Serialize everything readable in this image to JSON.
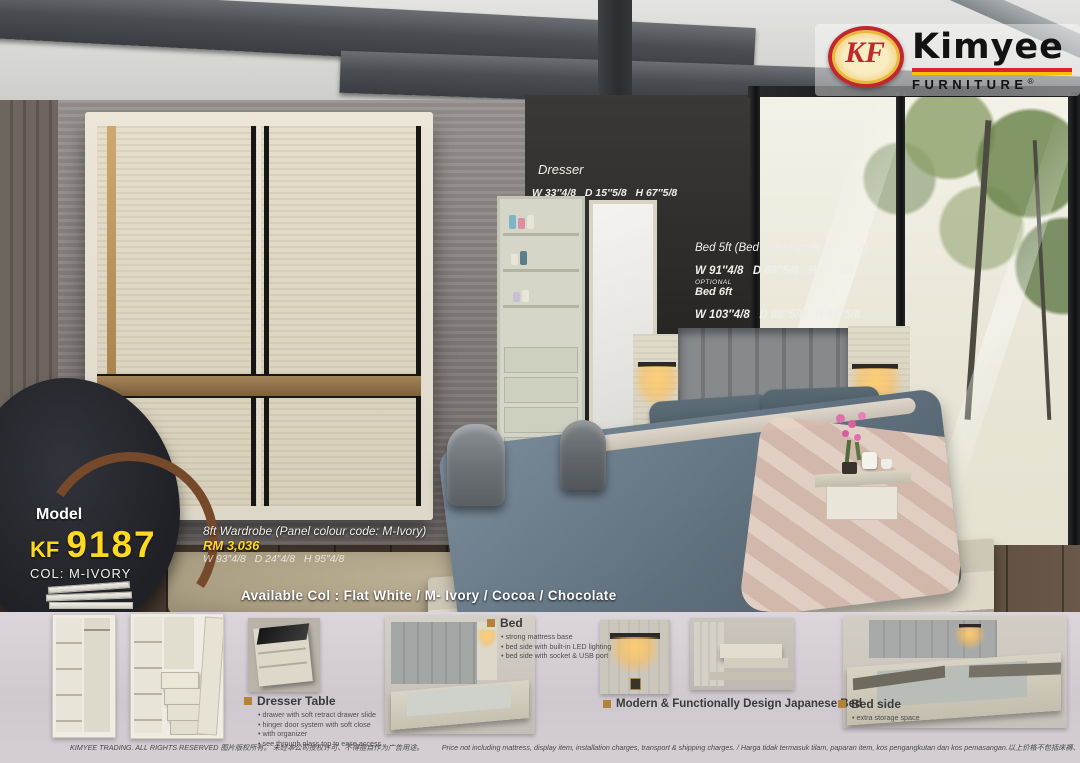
{
  "brand": {
    "badge": "KF",
    "name": "Kimyee",
    "tagline": "FURNITURE",
    "registered": "®",
    "colors": {
      "logo_red": "#c1272d",
      "logo_yellow": "#f5c400",
      "accent_yellow": "#ffd91f"
    }
  },
  "scene": {
    "dresser": {
      "label": "Dresser",
      "dims": "W 33″4/8   D 15″5/8   H 67″5/8"
    },
    "bed": {
      "title": "Bed 5ft (Bed colour code :989-13)",
      "dims_5ft": "W 91″4/8   D 88″5/8   H 47″5/8",
      "optional": "OPTIONAL",
      "label_6ft": "Bed 6ft",
      "dims_6ft": "W 103″4/8   D 88″5/8   H 47″5/8"
    },
    "model": {
      "label": "Model",
      "prefix": "KF",
      "number": "9187",
      "colour": "COL: M-IVORY"
    },
    "wardrobe": {
      "title": "8ft Wardrobe (Panel colour code: M-Ivory)",
      "price": "RM 3,036",
      "dims": "W 93″4/8   D 24″4/8   H 95″4/8"
    },
    "available_colours": "Available Col : Flat White / M- Ivory / Cocoa / Chocolate"
  },
  "features": {
    "dresser_table": {
      "title": "Dresser Table",
      "bullets": [
        "drawer with soft retract drawer slide",
        "hinger door system with soft close",
        "with organizer",
        "see through glass top to ease access"
      ]
    },
    "bed": {
      "title": "Bed",
      "bullets": [
        "strong mattress base",
        "bed side with built-in LED lighting",
        "bed side with socket  & USB port"
      ]
    },
    "japanese_bed": {
      "title": "Modern & Functionally Design Japanese Bed"
    },
    "bed_side": {
      "title": "Bed side",
      "bullets": [
        "extra storage space"
      ]
    }
  },
  "footer": {
    "left": "KIMYEE TRADING. ALL RIGHTS RESERVED 图片版权所有。 未经本公司授权许可、不得擅自作为广告用途。",
    "right": "Price not including mattress, display item, installation charges, transport & shipping charges. / Harga tidak termasuk tilam, paparan item, kos pengangkutan dan kos pemasangan.以上价格不包括床褥、装饰品、安装费、运输费和搬运费。"
  }
}
